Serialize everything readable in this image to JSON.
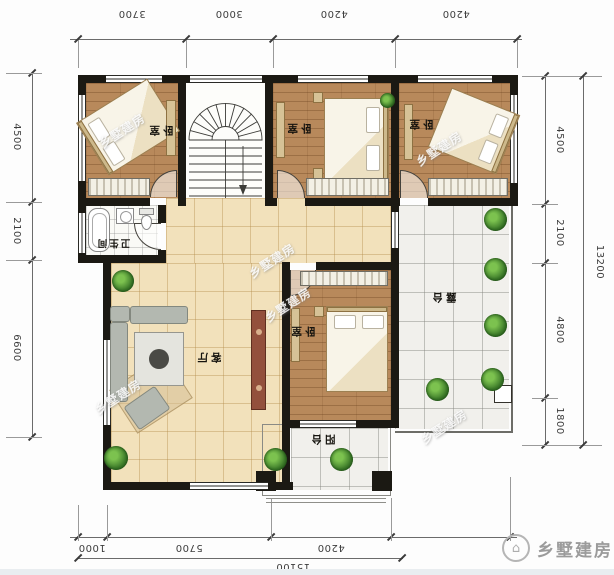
{
  "dimensions": {
    "top": [
      "3700",
      "3000",
      "4200",
      "4200"
    ],
    "left": [
      "4500",
      "2100",
      "6600"
    ],
    "right": [
      "4500",
      "2100",
      "4800",
      "1800"
    ],
    "right_total": "13200",
    "bottom": [
      "1000",
      "5700",
      "4200"
    ],
    "bottom_total": "15100"
  },
  "rooms": {
    "bedroom1": "卧室",
    "bedroom2": "卧室",
    "bedroom3": "卧室",
    "bedroom4": "卧室",
    "bathroom": "卫生间",
    "living_room": "客厅",
    "terrace": "露台",
    "balcony": "阳台"
  },
  "watermark": {
    "text": "乡墅建房"
  },
  "brand": {
    "name": "乡墅建房",
    "icon": "house-logo"
  },
  "colors": {
    "wall": "#1b1913",
    "wood_floor": "#b8895b",
    "tile_floor": "#f2e1bb",
    "stone_floor": "#f1f0ec",
    "bath_floor": "#fafaf6",
    "plant_green": "#3f7d2b",
    "tv_cabinet": "#93503c",
    "dimension_text": "#3d3d3d",
    "watermark_white": "#ffffff",
    "brand_gray": "#9b9b9b"
  }
}
